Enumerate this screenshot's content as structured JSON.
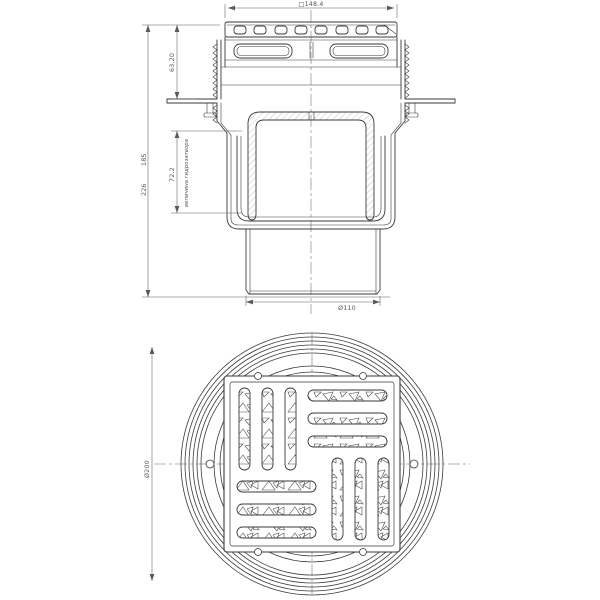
{
  "side_view": {
    "grate_width": "□148.4",
    "upper_height": "63.20",
    "total_height": "226",
    "body_height": "185",
    "water_seal_height": "72.2",
    "water_seal_label": "величина гидрозатвора",
    "outlet_diameter": "Ø110"
  },
  "top_view": {
    "outer_diameter": "Ø200"
  }
}
